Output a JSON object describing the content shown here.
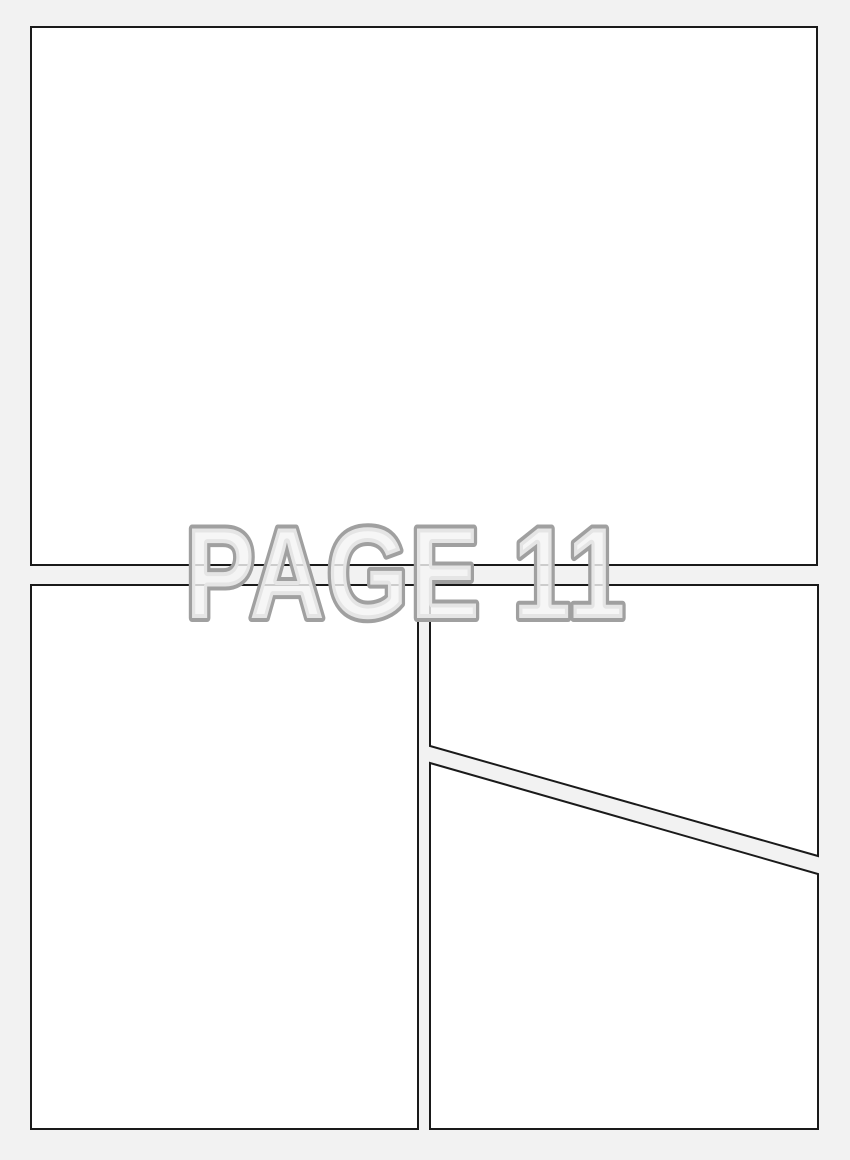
{
  "page": {
    "title": "PAGE 11",
    "background_color": "#f2f2f2",
    "panel_fill_color": "#ffffff",
    "panel_border_color": "#1a1a1a",
    "title_fill_color": "#f4f4f4",
    "title_stroke_color": "#a0a0a0"
  },
  "panels": [
    {
      "id": "panel-1",
      "shape": "rectangle",
      "position": "top-full-width"
    },
    {
      "id": "panel-2",
      "shape": "rectangle",
      "position": "bottom-left"
    },
    {
      "id": "panel-3",
      "shape": "trapezoid",
      "position": "middle-right"
    },
    {
      "id": "panel-4",
      "shape": "trapezoid",
      "position": "bottom-right"
    }
  ]
}
